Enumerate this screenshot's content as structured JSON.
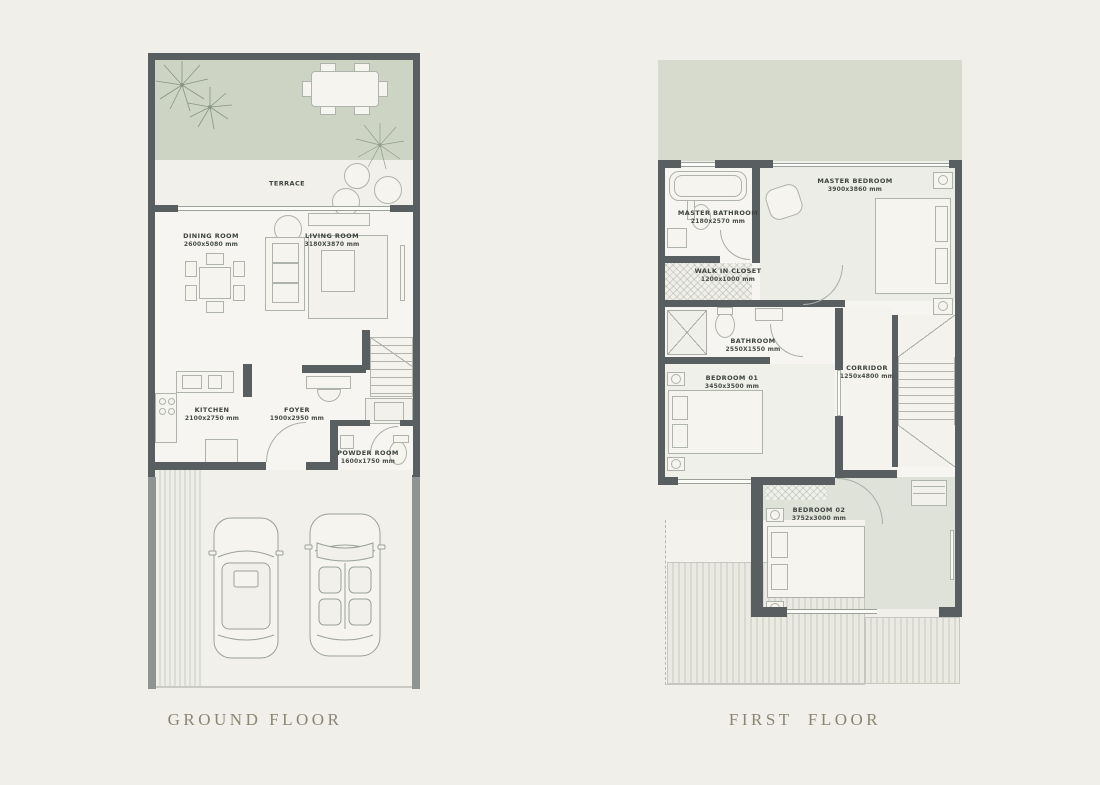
{
  "page": {
    "background": "#f0efe9",
    "wall_color": "#595e60",
    "garden_green": "#cdd4c4",
    "terrace_green": "#d6dbcd",
    "title_color": "#8c8573"
  },
  "floors": [
    {
      "title": "GROUND FLOOR",
      "rooms": [
        {
          "name": "TERRACE",
          "dims": ""
        },
        {
          "name": "DINING ROOM",
          "dims": "2600x5080 mm"
        },
        {
          "name": "LIVING ROOM",
          "dims": "3180X3870 mm"
        },
        {
          "name": "KITCHEN",
          "dims": "2100x2750 mm"
        },
        {
          "name": "FOYER",
          "dims": "1900x2950 mm"
        },
        {
          "name": "POWDER ROOM",
          "dims": "1600x1750 mm"
        }
      ]
    },
    {
      "title": "FIRST  FLOOR",
      "rooms": [
        {
          "name": "MASTER BATHROOM",
          "dims": "2180x2570 mm"
        },
        {
          "name": "MASTER BEDROOM",
          "dims": "3900x3860 mm"
        },
        {
          "name": "WALK IN CLOSET",
          "dims": "1200x1000 mm"
        },
        {
          "name": "BATHROOM",
          "dims": "2550X1550 mm"
        },
        {
          "name": "BEDROOM 01",
          "dims": "3450x3500 mm"
        },
        {
          "name": "CORRIDOR",
          "dims": "1250x4800 mm"
        },
        {
          "name": "BEDROOM 02",
          "dims": "3752x3000 mm"
        }
      ]
    }
  ]
}
